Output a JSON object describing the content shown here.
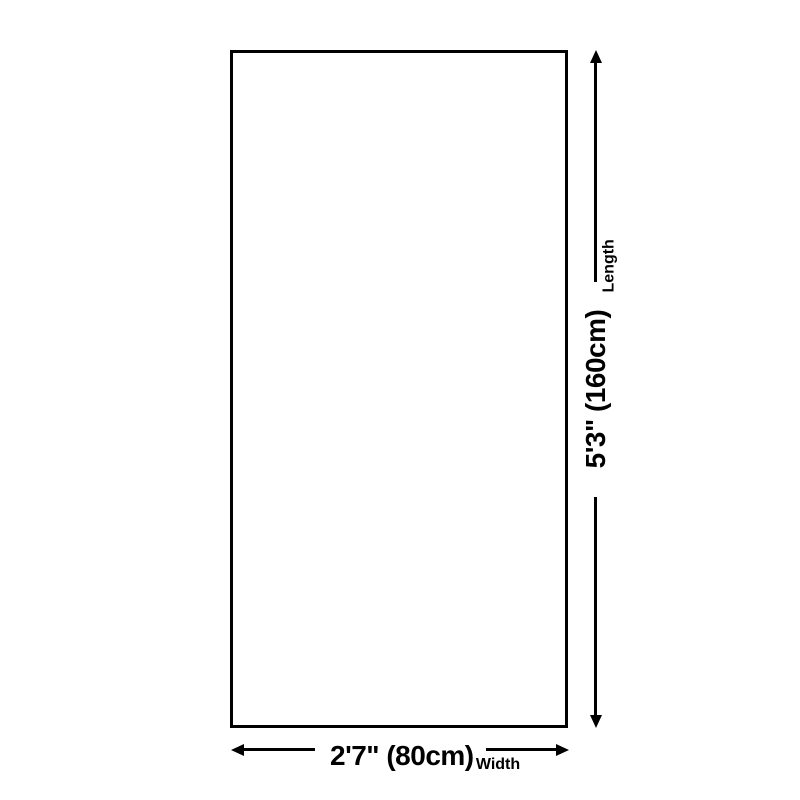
{
  "diagram": {
    "shape": "rectangle",
    "colors": {
      "line": "#000000",
      "background": "#ffffff"
    },
    "length": {
      "value": "5'3\" (160cm)",
      "label": "Length"
    },
    "width": {
      "value": "2'7\" (80cm)",
      "label": "Width"
    }
  }
}
